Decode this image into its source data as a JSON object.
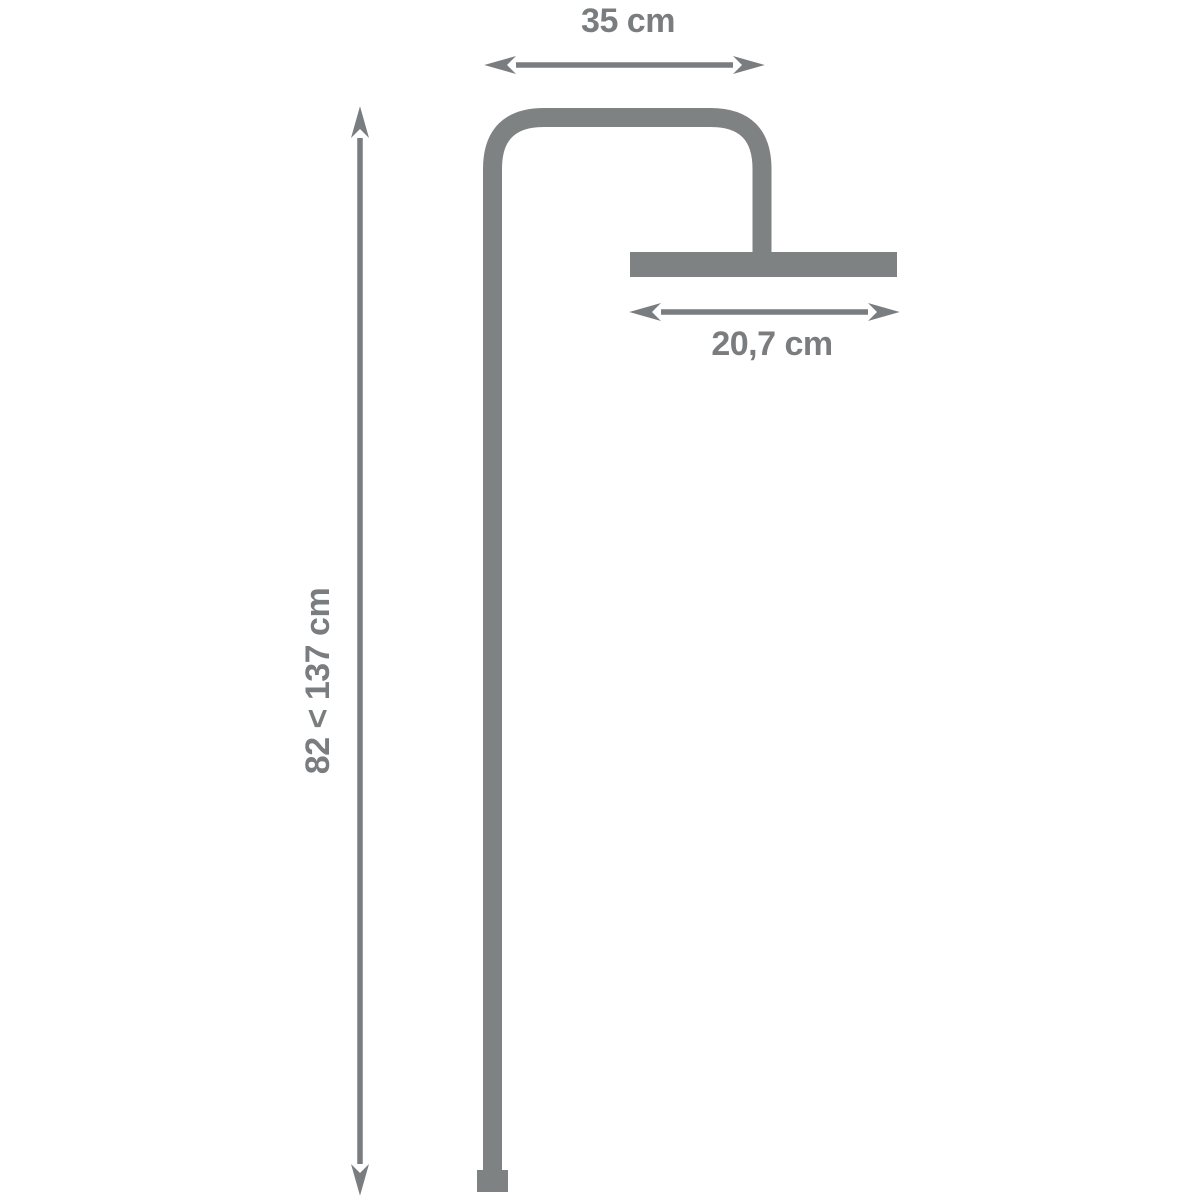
{
  "diagram": {
    "kind": "shower-column-dimension-drawing",
    "labels": {
      "top_width": "35 cm",
      "head_width": "20,7 cm",
      "height_range": "82 < 137 cm"
    },
    "colors": {
      "pipe": "#7f8283",
      "dimension": "#7a7d7f",
      "background": "#ffffff"
    }
  }
}
